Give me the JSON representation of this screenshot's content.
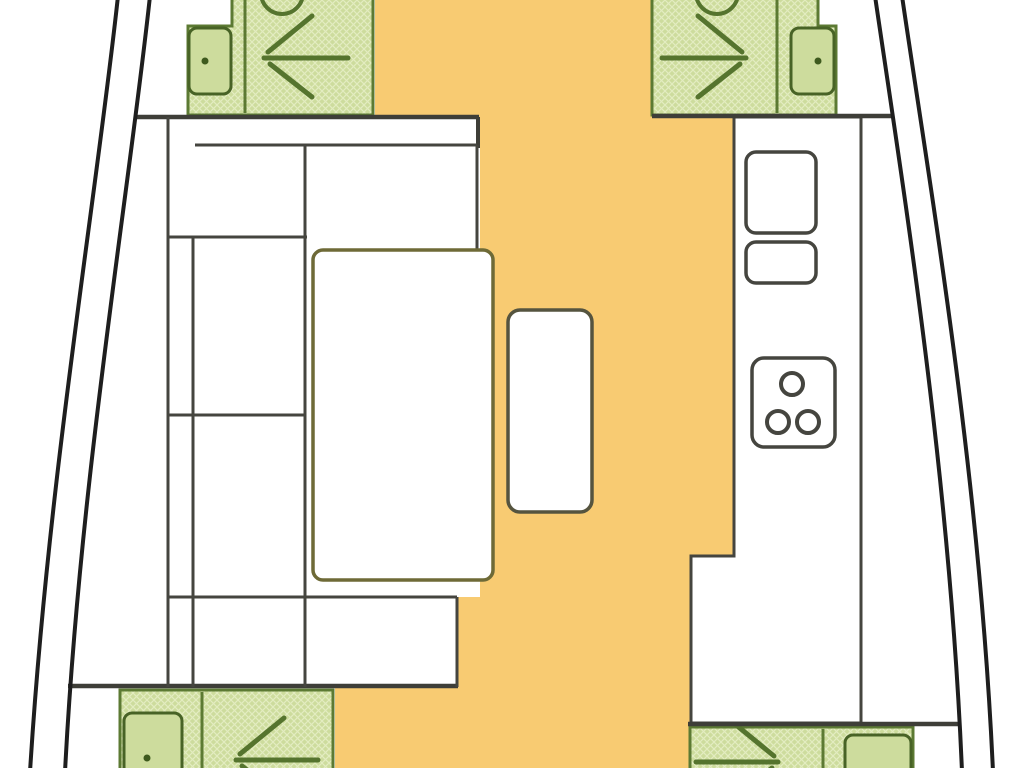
{
  "document": {
    "kind": "yacht-interior-floorplan",
    "canvas": {
      "width": 1024,
      "height": 768,
      "background": "#ffffff"
    }
  },
  "palette": {
    "floor_orange": "#F8CB72",
    "cabin_green": "#CDDC9D",
    "cabin_hatch_light": "#E3ECC0",
    "cabin_border": "#5C7A33",
    "glyph_green": "#55742E",
    "door_border": "#486326",
    "door_dot": "#3E5A1E",
    "wall_gray": "#3E3E38",
    "furniture_gray": "#45453F",
    "table_olive": "#6E6A37",
    "hull_black": "#1E1E1E"
  },
  "elements": [
    {
      "name": "saloon-floor",
      "type": "polygon",
      "interactable": false,
      "points": "375,0 652,0 652,117 734,117 734,556 691,556 691,768 335,768 335,687 457,687 457,597 480,597 480,117 375,117",
      "fill": "#F8CB72",
      "stroke": "none",
      "sw": 0
    },
    {
      "name": "cabin-forward-port",
      "type": "polygon",
      "interactable": false,
      "points": "232,-6 373,-6 373,115 188,115 188,26 232,26",
      "fill": "hatch",
      "stroke": "#5C7A33",
      "sw": 3
    },
    {
      "name": "cabin-forward-starboard",
      "type": "polygon",
      "interactable": false,
      "points": "652,-6 818,-6 818,26 836,26 836,115 652,115",
      "fill": "hatch",
      "stroke": "#5C7A33",
      "sw": 3
    },
    {
      "name": "cabin-aft-port",
      "type": "polygon",
      "interactable": false,
      "points": "120,690 333,690 333,774 120,774",
      "fill": "hatch",
      "stroke": "#5C7A33",
      "sw": 3
    },
    {
      "name": "cabin-aft-starboard",
      "type": "polygon",
      "interactable": false,
      "points": "690,727 913,727 913,774 690,774",
      "fill": "hatch",
      "stroke": "#5C7A33",
      "sw": 3
    },
    {
      "name": "cabin-divider-forward-port",
      "type": "line",
      "interactable": false,
      "x1": 245,
      "y1": -4,
      "x2": 245,
      "y2": 113,
      "stroke": "#5C7A33",
      "sw": 3
    },
    {
      "name": "cabin-divider-forward-starboard",
      "type": "line",
      "interactable": false,
      "x1": 777,
      "y1": -4,
      "x2": 777,
      "y2": 113,
      "stroke": "#5C7A33",
      "sw": 3
    },
    {
      "name": "cabin-divider-aft-port",
      "type": "line",
      "interactable": false,
      "x1": 202,
      "y1": 692,
      "x2": 202,
      "y2": 772,
      "stroke": "#5C7A33",
      "sw": 3
    },
    {
      "name": "cabin-divider-aft-starboard",
      "type": "line",
      "interactable": false,
      "x1": 823,
      "y1": 729,
      "x2": 823,
      "y2": 772,
      "stroke": "#5C7A33",
      "sw": 3
    },
    {
      "name": "hatch-circle-port",
      "type": "circle",
      "interactable": false,
      "cx": 282,
      "cy": -7,
      "r": 21,
      "fill": "none",
      "stroke": "#55742E",
      "sw": 4
    },
    {
      "name": "hatch-circle-starboard",
      "type": "circle",
      "interactable": false,
      "cx": 717,
      "cy": -7,
      "r": 21,
      "fill": "none",
      "stroke": "#55742E",
      "sw": 4
    },
    {
      "name": "door-forward-port",
      "type": "rect",
      "interactable": false,
      "x": 189,
      "y": 28,
      "w": 42,
      "h": 66,
      "rx": 8,
      "fill": "#CDDC9D",
      "stroke": "#486326",
      "sw": 3
    },
    {
      "name": "door-forward-starboard",
      "type": "rect",
      "interactable": false,
      "x": 791,
      "y": 28,
      "w": 43,
      "h": 66,
      "rx": 8,
      "fill": "#CDDC9D",
      "stroke": "#486326",
      "sw": 3
    },
    {
      "name": "door-aft-port",
      "type": "rect",
      "interactable": false,
      "x": 124,
      "y": 713,
      "w": 58,
      "h": 62,
      "rx": 8,
      "fill": "#CDDC9D",
      "stroke": "#486326",
      "sw": 3
    },
    {
      "name": "door-aft-starboard",
      "type": "rect",
      "interactable": false,
      "x": 845,
      "y": 735,
      "w": 66,
      "h": 42,
      "rx": 8,
      "fill": "#CDDC9D",
      "stroke": "#486326",
      "sw": 3
    },
    {
      "name": "door-knob-dot-forward-port",
      "type": "circle",
      "interactable": false,
      "cx": 205,
      "cy": 61,
      "r": 3.5,
      "fill": "#3E5A1E",
      "stroke": "none",
      "sw": 0
    },
    {
      "name": "door-knob-dot-forward-starboard",
      "type": "circle",
      "interactable": false,
      "cx": 818,
      "cy": 61,
      "r": 3.5,
      "fill": "#3E5A1E",
      "stroke": "none",
      "sw": 0
    },
    {
      "name": "door-knob-dot-aft-port",
      "type": "circle",
      "interactable": false,
      "cx": 147,
      "cy": 758,
      "r": 3.5,
      "fill": "#3E5A1E",
      "stroke": "none",
      "sw": 0
    },
    {
      "name": "berth-arrow-forward-port",
      "type": "lines",
      "interactable": false,
      "stroke": "#55742E",
      "sw": 5,
      "cap": "round",
      "segments": [
        [
          264,
          58,
          348,
          58
        ],
        [
          268,
          52,
          312,
          16
        ],
        [
          270,
          64,
          312,
          97
        ]
      ]
    },
    {
      "name": "berth-arrow-forward-starboard",
      "type": "lines",
      "interactable": false,
      "stroke": "#55742E",
      "sw": 5,
      "cap": "round",
      "segments": [
        [
          662,
          58,
          746,
          58
        ],
        [
          742,
          52,
          698,
          16
        ],
        [
          740,
          64,
          698,
          97
        ]
      ]
    },
    {
      "name": "berth-arrow-aft-port",
      "type": "lines",
      "interactable": false,
      "stroke": "#55742E",
      "sw": 5,
      "cap": "round",
      "segments": [
        [
          236,
          760,
          318,
          760
        ],
        [
          240,
          754,
          284,
          718
        ],
        [
          242,
          766,
          284,
          799
        ]
      ]
    },
    {
      "name": "berth-arrow-aft-starboard",
      "type": "lines",
      "interactable": false,
      "stroke": "#55742E",
      "sw": 5,
      "cap": "round",
      "segments": [
        [
          696,
          762,
          778,
          762
        ],
        [
          774,
          756,
          730,
          720
        ],
        [
          772,
          768,
          730,
          801
        ]
      ]
    },
    {
      "name": "galley-counter",
      "type": "polygon",
      "interactable": false,
      "points": "734,117 861,117 861,723 691,723 691,556 734,556",
      "fill": "#ffffff",
      "stroke": "#45453F",
      "sw": 3
    },
    {
      "name": "galley-sink-large",
      "type": "rect",
      "interactable": false,
      "x": 746,
      "y": 152,
      "w": 70,
      "h": 81,
      "rx": 10,
      "fill": "#ffffff",
      "stroke": "#45453F",
      "sw": 3.5
    },
    {
      "name": "galley-sink-small",
      "type": "rect",
      "interactable": false,
      "x": 746,
      "y": 242,
      "w": 70,
      "h": 41,
      "rx": 10,
      "fill": "#ffffff",
      "stroke": "#45453F",
      "sw": 3.5
    },
    {
      "name": "galley-stove",
      "type": "rect",
      "interactable": false,
      "x": 752,
      "y": 358,
      "w": 83,
      "h": 89,
      "rx": 12,
      "fill": "#ffffff",
      "stroke": "#45453F",
      "sw": 3.5
    },
    {
      "name": "stove-burner-top",
      "type": "circle",
      "interactable": false,
      "cx": 792,
      "cy": 384,
      "r": 11,
      "fill": "#ffffff",
      "stroke": "#45453F",
      "sw": 4
    },
    {
      "name": "stove-burner-left",
      "type": "circle",
      "interactable": false,
      "cx": 778,
      "cy": 422,
      "r": 11,
      "fill": "#ffffff",
      "stroke": "#45453F",
      "sw": 4
    },
    {
      "name": "stove-burner-right",
      "type": "circle",
      "interactable": false,
      "cx": 808,
      "cy": 422,
      "r": 11,
      "fill": "#ffffff",
      "stroke": "#45453F",
      "sw": 4
    },
    {
      "name": "wall-forward-port",
      "type": "line",
      "interactable": false,
      "x1": 137,
      "y1": 117,
      "x2": 479,
      "y2": 117,
      "stroke": "#3E3E38",
      "sw": 4.5
    },
    {
      "name": "wall-forward-starboard",
      "type": "line",
      "interactable": false,
      "x1": 652,
      "y1": 116,
      "x2": 892,
      "y2": 116,
      "stroke": "#3E3E38",
      "sw": 4.5
    },
    {
      "name": "wall-step-saloon",
      "type": "line",
      "interactable": false,
      "x1": 478,
      "y1": 117,
      "x2": 478,
      "y2": 148,
      "stroke": "#3E3E38",
      "sw": 4
    },
    {
      "name": "wall-aft-port",
      "type": "line",
      "interactable": false,
      "x1": 68,
      "y1": 686,
      "x2": 458,
      "y2": 686,
      "stroke": "#3E3E38",
      "sw": 4.5
    },
    {
      "name": "wall-aft-starboard",
      "type": "line",
      "interactable": false,
      "x1": 688,
      "y1": 724,
      "x2": 958,
      "y2": 724,
      "stroke": "#3E3E38",
      "sw": 4.5
    },
    {
      "name": "sofa-top-seat",
      "type": "lines",
      "interactable": false,
      "stroke": "#45453F",
      "sw": 3,
      "cap": "butt",
      "segments": [
        [
          195,
          145,
          477,
          145
        ],
        [
          477,
          145,
          477,
          251
        ],
        [
          168,
          237,
          307,
          237
        ]
      ]
    },
    {
      "name": "sofa-left-column",
      "type": "lines",
      "interactable": false,
      "stroke": "#45453F",
      "sw": 3,
      "cap": "butt",
      "segments": [
        [
          168,
          117,
          168,
          687
        ],
        [
          193,
          237,
          193,
          687
        ],
        [
          305,
          145,
          305,
          687
        ],
        [
          168,
          415,
          305,
          415
        ],
        [
          168,
          597,
          457,
          597
        ],
        [
          457,
          597,
          457,
          687
        ]
      ]
    },
    {
      "name": "saloon-table",
      "type": "rect",
      "interactable": false,
      "x": 313,
      "y": 250,
      "w": 180,
      "h": 330,
      "rx": 10,
      "fill": "#ffffff",
      "stroke": "#6E6A37",
      "sw": 3.5
    },
    {
      "name": "saloon-side-table",
      "type": "rect",
      "interactable": false,
      "x": 508,
      "y": 310,
      "w": 84,
      "h": 202,
      "rx": 12,
      "fill": "#ffffff",
      "stroke": "#55543F",
      "sw": 3.5
    },
    {
      "name": "hull-line-port-outer",
      "type": "path",
      "interactable": false,
      "d": "M118 -4 C96 200 48 480 30 772",
      "fill": "none",
      "stroke": "#1E1E1E",
      "sw": 4
    },
    {
      "name": "hull-line-port-inner",
      "type": "path",
      "interactable": false,
      "d": "M150 -4 C128 200 80 480 65 772",
      "fill": "none",
      "stroke": "#1E1E1E",
      "sw": 4
    },
    {
      "name": "hull-line-starboard-inner",
      "type": "path",
      "interactable": false,
      "d": "M875 -4 C905 200 950 480 962 772",
      "fill": "none",
      "stroke": "#1E1E1E",
      "sw": 4
    },
    {
      "name": "hull-line-starboard-outer",
      "type": "path",
      "interactable": false,
      "d": "M902 -4 C932 200 980 480 993 772",
      "fill": "none",
      "stroke": "#1E1E1E",
      "sw": 4
    }
  ]
}
